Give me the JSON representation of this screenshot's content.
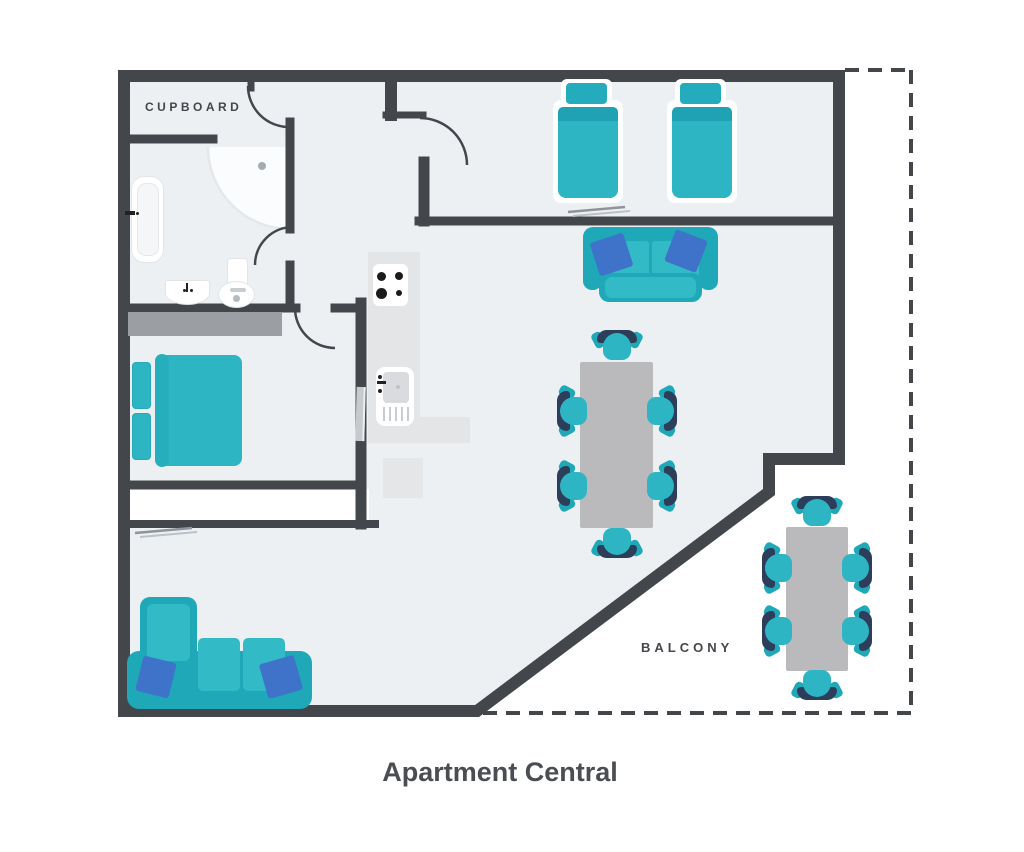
{
  "title": "Apartment Central",
  "labels": {
    "cupboard": "CUPBOARD",
    "balcony": "BALCONY"
  },
  "colors": {
    "wall": "#43474b",
    "floor": "#edf0f3",
    "teal": "#2db5c3",
    "teal-dark": "#1fa8b8",
    "navy": "#2c3e59",
    "blue": "#3e73c9",
    "table-gray": "#bababc",
    "counter-gray": "#e3e5e7",
    "wardrobe-gray": "#9b9fa3",
    "ink": "#43474b",
    "fixture-white": "#ffffff"
  },
  "furniture": {
    "cupboard": [],
    "bathroom": [
      "bathtub",
      "corner-shower",
      "basin",
      "toilet"
    ],
    "bedroom_small": [
      "double-bed",
      "wardrobe",
      "wall-mirror"
    ],
    "bedroom_large": [
      "single-bed",
      "single-bed",
      "wall-shelf"
    ],
    "kitchen": [
      "l-shaped-counter",
      "stove-4-burners",
      "sink-with-drainer",
      "appliance"
    ],
    "living_dining": [
      "sofa-2-seat",
      "corner-sofa",
      "dining-table",
      "chair x6",
      "wall-shelf"
    ],
    "balcony": [
      "outdoor-table",
      "chair x6"
    ]
  }
}
